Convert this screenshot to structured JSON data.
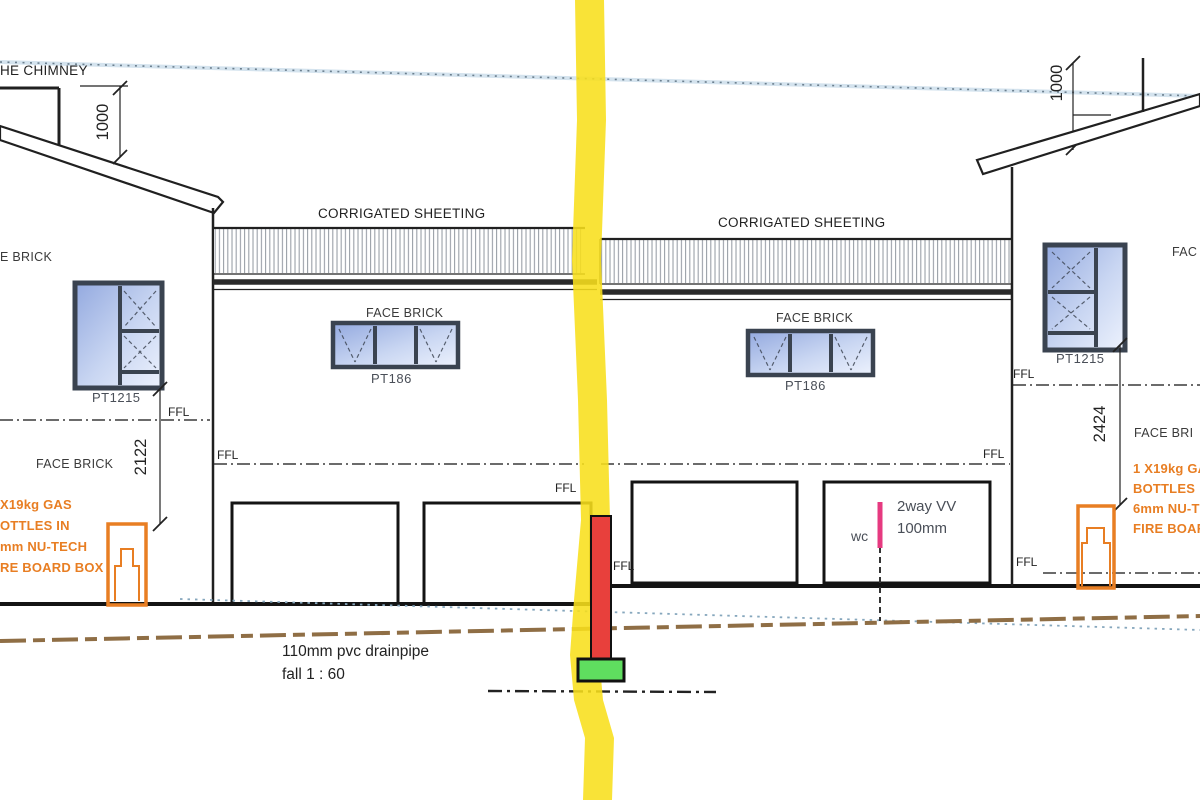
{
  "colors": {
    "section_marker_yellow": "#F8DF1B",
    "pipe_red": "#E8403C",
    "footing_green": "#5FDD5F",
    "vent_pink": "#E63A80",
    "annotation_orange": "#E87E23",
    "window_glass": "#93A9DF",
    "window_glass_light": "#EDF2FD",
    "window_frame": "#3A4350",
    "drain_brown": "#8F6E45",
    "boundary_blue": "#6B7F8E"
  },
  "labels": {
    "chimney": "HE CHIMNEY",
    "corrugated_sheeting_left": "CORRIGATED SHEETING",
    "corrugated_sheeting_right": "CORRIGATED SHEETING",
    "face_brick_left_top": "E BRICK",
    "face_brick_left": "FACE BRICK",
    "face_brick_center_left": "FACE BRICK",
    "face_brick_center_right": "FACE BRICK",
    "face_brick_right_top": "FAC",
    "face_brick_right": "FACE BRI",
    "ffl": "FFL",
    "wc": "wc",
    "vent_line1": "2way VV",
    "vent_line2": "100mm",
    "drain_line1": "110mm pvc drainpipe",
    "drain_line2": "fall 1 : 60"
  },
  "windows": {
    "left": "PT1215",
    "center_left": "PT186",
    "center_right": "PT186",
    "right": "PT1215"
  },
  "dimensions": {
    "left_roof_offset": "1000",
    "right_roof_offset": "1000",
    "left_height": "2122",
    "right_height": "2424"
  },
  "gas_note_left": [
    "X19kg GAS",
    "OTTLES IN",
    "mm NU-TECH",
    "RE BOARD BOX"
  ],
  "gas_note_right": [
    "1 X19kg GA",
    "BOTTLES",
    "6mm NU-T",
    "FIRE BOAR"
  ]
}
